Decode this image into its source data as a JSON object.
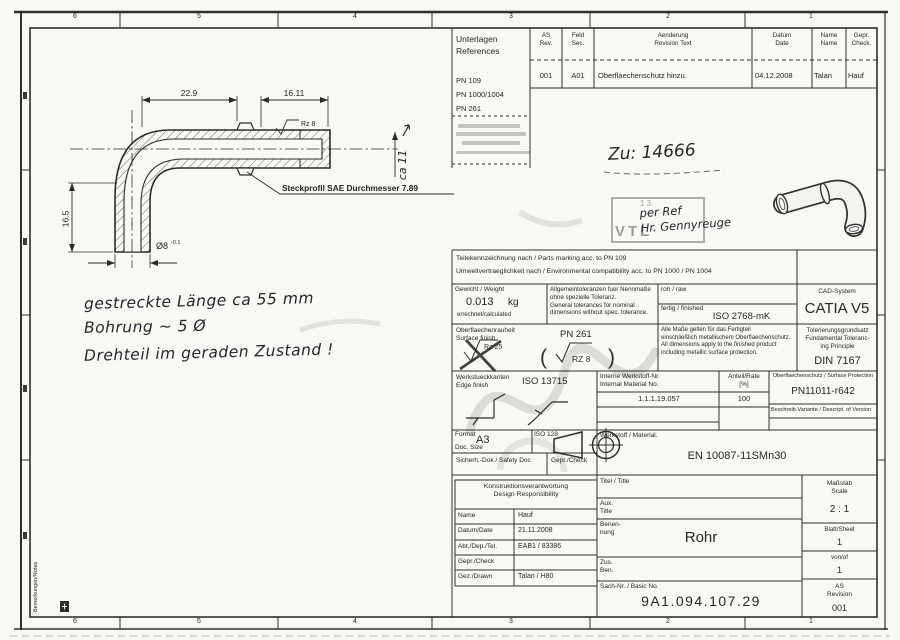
{
  "colors": {
    "ink": "#2e2e2e",
    "paper": "#f8f8f4",
    "faint": "#c9c9c9"
  },
  "frame": {
    "top_numbers": [
      "6",
      "5",
      "4",
      "3",
      "2",
      "1"
    ],
    "bottom_numbers": [
      "6",
      "5",
      "4",
      "3",
      "2",
      "1"
    ],
    "side_note": "Bemerkungen/Notes"
  },
  "references": {
    "title": "Unterlagen\nReferences",
    "items": [
      "PN 109",
      "PN 1000/1004",
      "PN 261"
    ]
  },
  "revision": {
    "h_rev": "AS\nRev.",
    "h_sec": "Feld\nSec.",
    "h_text": "Aenderung\nRevision Text",
    "h_date": "Datum\nDate",
    "h_name": "Name\nName",
    "h_check": "Gepr.\nCheck.",
    "r_rev": "001",
    "r_sec": "A01",
    "r_text": "Oberflaechenschutz hinzu.",
    "r_date": "04.12.2008",
    "r_name": "Talan",
    "r_check": "Hauf"
  },
  "hand": {
    "zu": "Zu: 14666",
    "stamp_top": "1 3.",
    "stamp_vtl": "VTL",
    "stamp_hand": "per Ref\nHr. Gennyreuge"
  },
  "drawing": {
    "dim_a": "22.9",
    "dim_b": "16.11",
    "rz": "Rz 8",
    "dim_c": "16.5",
    "dia": "Ø8",
    "dia_tol": "-0.1",
    "hand_dim": "ca 11",
    "leader": "Steckprofil SAE Durchmesser 7.89",
    "hand_notes": [
      "gestreckte Länge ca 55 mm",
      "Bohrung ~ 5 Ø",
      "Drehteil im geraden Zustand !"
    ]
  },
  "tol": {
    "marking": "Teilekennzeichnung nach / Parts marking acc. to   PN 109\nUmweltvertraeglichkeit nach / Environmental compatibility acc. to   PN 1000 / PN 1004",
    "weight_lbl": "Gewicht / Weight",
    "weight_val": "0.013",
    "weight_unit": "kg",
    "weight_sub": "errechnet/calculated",
    "gen": "Allgemeintoleranzen fuer Nennmaße\nohne spezielle Toleranz.\nGeneral tolerances for nominal\ndimensions without spec. tolerance.",
    "raw": "roh / raw",
    "fin": "fertig / finished",
    "fin_val": "ISO 2768-mK",
    "cad": "CAD-System",
    "cad_val": "CATIA V5",
    "surf": "Oberflaechenrauheit\nSurface finish",
    "surf_std": "PN 261",
    "surf_old": "Rz 25",
    "surf_new": "RZ 8",
    "all_dims": "Alle Maße gelten für das Fertigteil\neinschließlich metallischem Oberflaechenschutz.\nAll dimensions apply to the finished product\nincluding metallic surface protection.",
    "principle": "Tolerierungsgrundsatz\nFundamental Toleranc-\ning Principle",
    "principle_val": "DIN 7167",
    "edge": "Werkstueckkanten\nEdge finish",
    "edge_std": "ISO 13715",
    "mat_no": "Interne Werkstoff-Nr.\nInternal Material No.",
    "mat_no_val": "1.1.1.19.057",
    "rate": "Anteil/Rate\n[%]",
    "rate_val": "100",
    "prot": "Oberflaechenschutz / Surface Protection",
    "prot_val": "PN11011-r642",
    "variant": "Beschreib.Variante / Descript. of Version",
    "format_lbl": "Format",
    "format_val": "A3",
    "format_sub": "Doc. Size",
    "iso128": "ISO 128",
    "safety": "Sicherh.-Dok / Safety Doc",
    "check": "Gepr./Check",
    "material": "Werkstoff / Material.",
    "material_val": "EN 10087-11SMn30"
  },
  "tb": {
    "resp": "Konstruktionsverantwortung\nDesign Responsibility",
    "rows": [
      {
        "label": "Name",
        "value": "Hauf"
      },
      {
        "label": "Datum/Date",
        "value": "21.11.2008"
      },
      {
        "label": "Abt./Dep./Tel.",
        "value": "EAB1 / 83386"
      },
      {
        "label": "Gepr./Check",
        "value": ""
      },
      {
        "label": "Gez./Drawn",
        "value": "Talan / H80"
      }
    ],
    "title": "Titel / Title",
    "aux": "Aux.\nTitle",
    "ben": "Benen-\nnung",
    "ben_val": "Rohr",
    "zus": "Zus.\nBen.",
    "basic": "Sach-Nr. / Basic No.",
    "basic_val": "9A1.094.107.29",
    "scale": "Maßstab\nScale",
    "scale_val": "2 : 1",
    "sheet": "Blatt/Sheet",
    "sheet_val": "1",
    "of": "von/of",
    "of_val": "1",
    "as_rev": "AS\nRevision",
    "as_rev_val": "001"
  }
}
